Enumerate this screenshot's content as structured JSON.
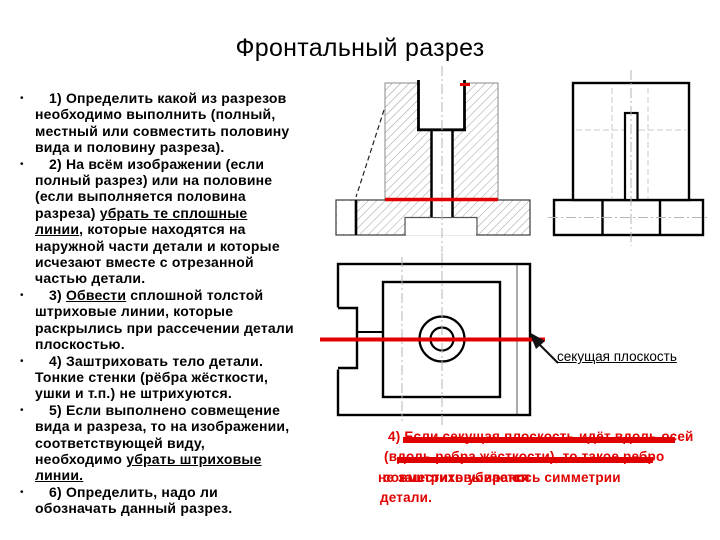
{
  "slide": {
    "title": "Фронтальный разрез",
    "bullet_char": "•"
  },
  "instructions": [
    {
      "segments": [
        {
          "t": "1) Определить какой из разрезов\nнеобходимо выполнить (полный,\nместный или совместить половину\nвида и половину разреза)."
        }
      ]
    },
    {
      "segments": [
        {
          "t": "2) На всём изображении (если\nполный разрез) или на половине\n(если выполняется половина\nразреза) "
        },
        {
          "t": "убрать те сплошные\nлинии",
          "u": true
        },
        {
          "t": ", которые находятся на\nнаружной части детали и которые\nисчезают вместе с отрезанной\nчастью детали."
        }
      ]
    },
    {
      "segments": [
        {
          "t": "3) "
        },
        {
          "t": "Обвести",
          "u": true
        },
        {
          "t": " сплошной толстой\nштриховые линии, которые\nраскрылись при рассечении детали\nплоскостью."
        }
      ]
    },
    {
      "segments": [
        {
          "t": "4) Заштриховать тело детали.\nТонкие стенки (рёбра жёсткости,\nушки и т.п.)  не штрихуются."
        }
      ]
    },
    {
      "segments": [
        {
          "t": "5) Если выполнено совмещение\nвида и разреза, то на изображении,\nсоответствующей виду,\nнеобходимо "
        },
        {
          "t": "убрать штриховые\nлинии.",
          "u": true
        }
      ]
    },
    {
      "segments": [
        {
          "t": "6) Определить, надо ли\nобозначать данный разрез."
        }
      ]
    }
  ],
  "callout": {
    "label": "секущая плоскость"
  },
  "red_overlay": {
    "lines": [
      {
        "t": "4) Если секущая плоскость идёт вдоль осей",
        "x": 388,
        "y": 429
      },
      {
        "t": "(вдоль ребра жёсткости), то такое ребро",
        "x": 384,
        "y": 449
      },
      {
        "t": "не заштриховывается",
        "x": 378,
        "y": 470
      },
      {
        "t": "совместить убирают",
        "x": 383,
        "y": 470
      },
      {
        "t": "ось симметрии",
        "x": 516,
        "y": 470
      },
      {
        "t": "детали.",
        "x": 380,
        "y": 490
      }
    ],
    "bars": [
      {
        "x": 403,
        "y": 437,
        "w": 272,
        "h": 6
      },
      {
        "x": 397,
        "y": 457,
        "w": 256,
        "h": 6
      }
    ]
  },
  "colors": {
    "accent_red": "#e10000",
    "text": "#000000",
    "hatch": "#9c9c9c",
    "centerline": "#b5b5b5"
  }
}
